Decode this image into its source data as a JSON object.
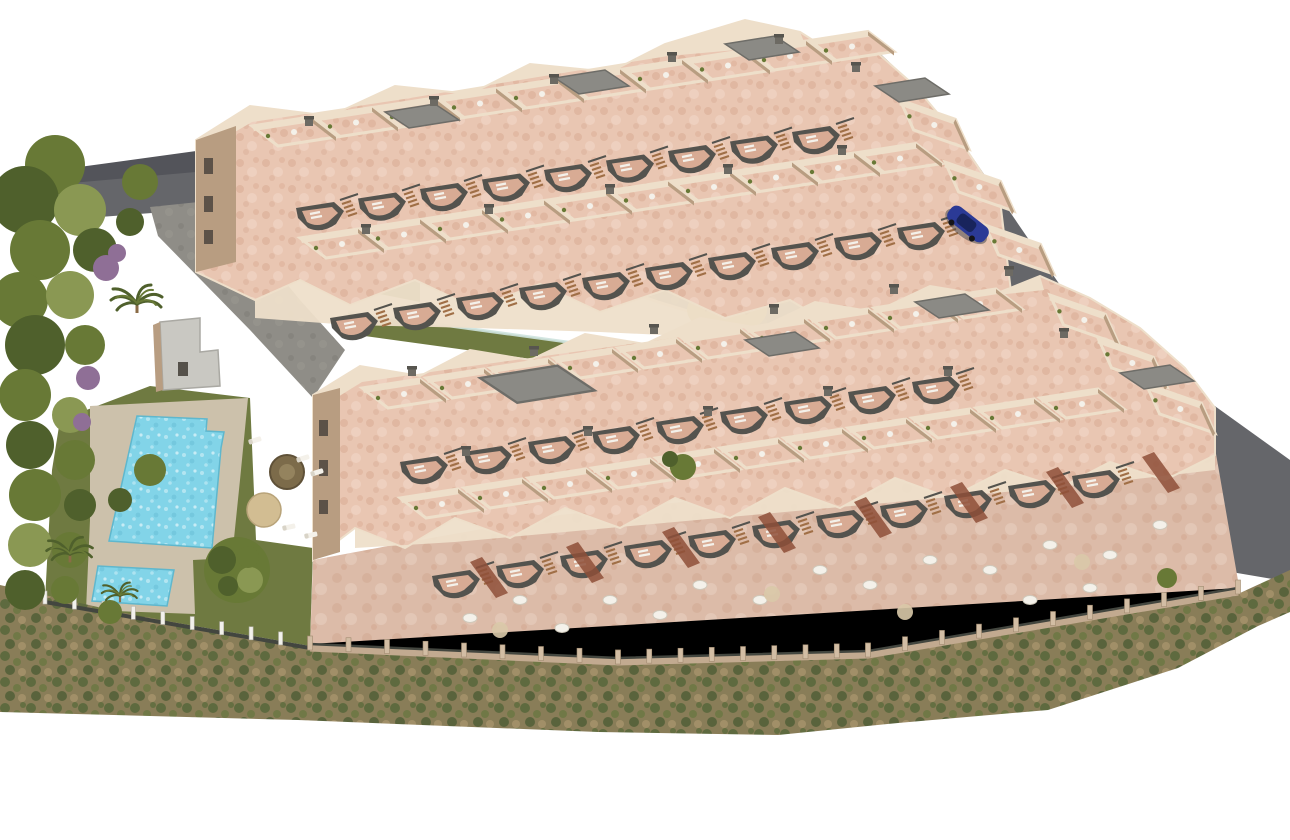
{
  "image": {
    "kind": "aerial-3d-architectural-render",
    "subject": "residential apartment complex with rooftop terraces, communal pool and gardens"
  },
  "palette": {
    "bg": "#ffffff",
    "road": "#65666a",
    "road_dark": "#53545a",
    "road_light": "#7b7c80",
    "paving": "#8f8d87",
    "paving_dark": "#7d7b75",
    "wall_sun": "#eedfca",
    "wall_mid": "#ddc8b0",
    "wall_shadow": "#b89d81",
    "wall_dark": "#9a7f63",
    "terrace_pink": "#e9c6b2",
    "terrace_pink_dark": "#d8ab94",
    "terrace_ground": "#dcbba8",
    "terracotta": "#8e4f38",
    "balcony_dark": "#54534e",
    "roof_gray": "#8b8a85",
    "roof_gray_dark": "#6e6d68",
    "stair_wood": "#a06f46",
    "lawn": "#6f7a41",
    "lawn_light": "#7d8a4b",
    "tree_green": "#687936",
    "tree_dark": "#4f602c",
    "tree_light": "#8a9853",
    "purple_shrub": "#8f6f96",
    "pool_water": "#82d4e8",
    "pool_light": "#bfeaf4",
    "deck_tan": "#ccc1ab",
    "scrub_base": "#897d58",
    "scrub_green": "#5a683c",
    "scrub_brown": "#a4926a",
    "fence_white": "#f2f1ec",
    "fence_dark": "#43463f",
    "masonry": "#c2aa90",
    "masonry_post": "#d2bda4",
    "car_blue": "#2b3a96",
    "car_glass": "#18245c",
    "playground_sand": "#d9b977",
    "play_wood": "#b08050",
    "glass": "#cfe4df",
    "white_furniture": "#f4f1ea"
  }
}
